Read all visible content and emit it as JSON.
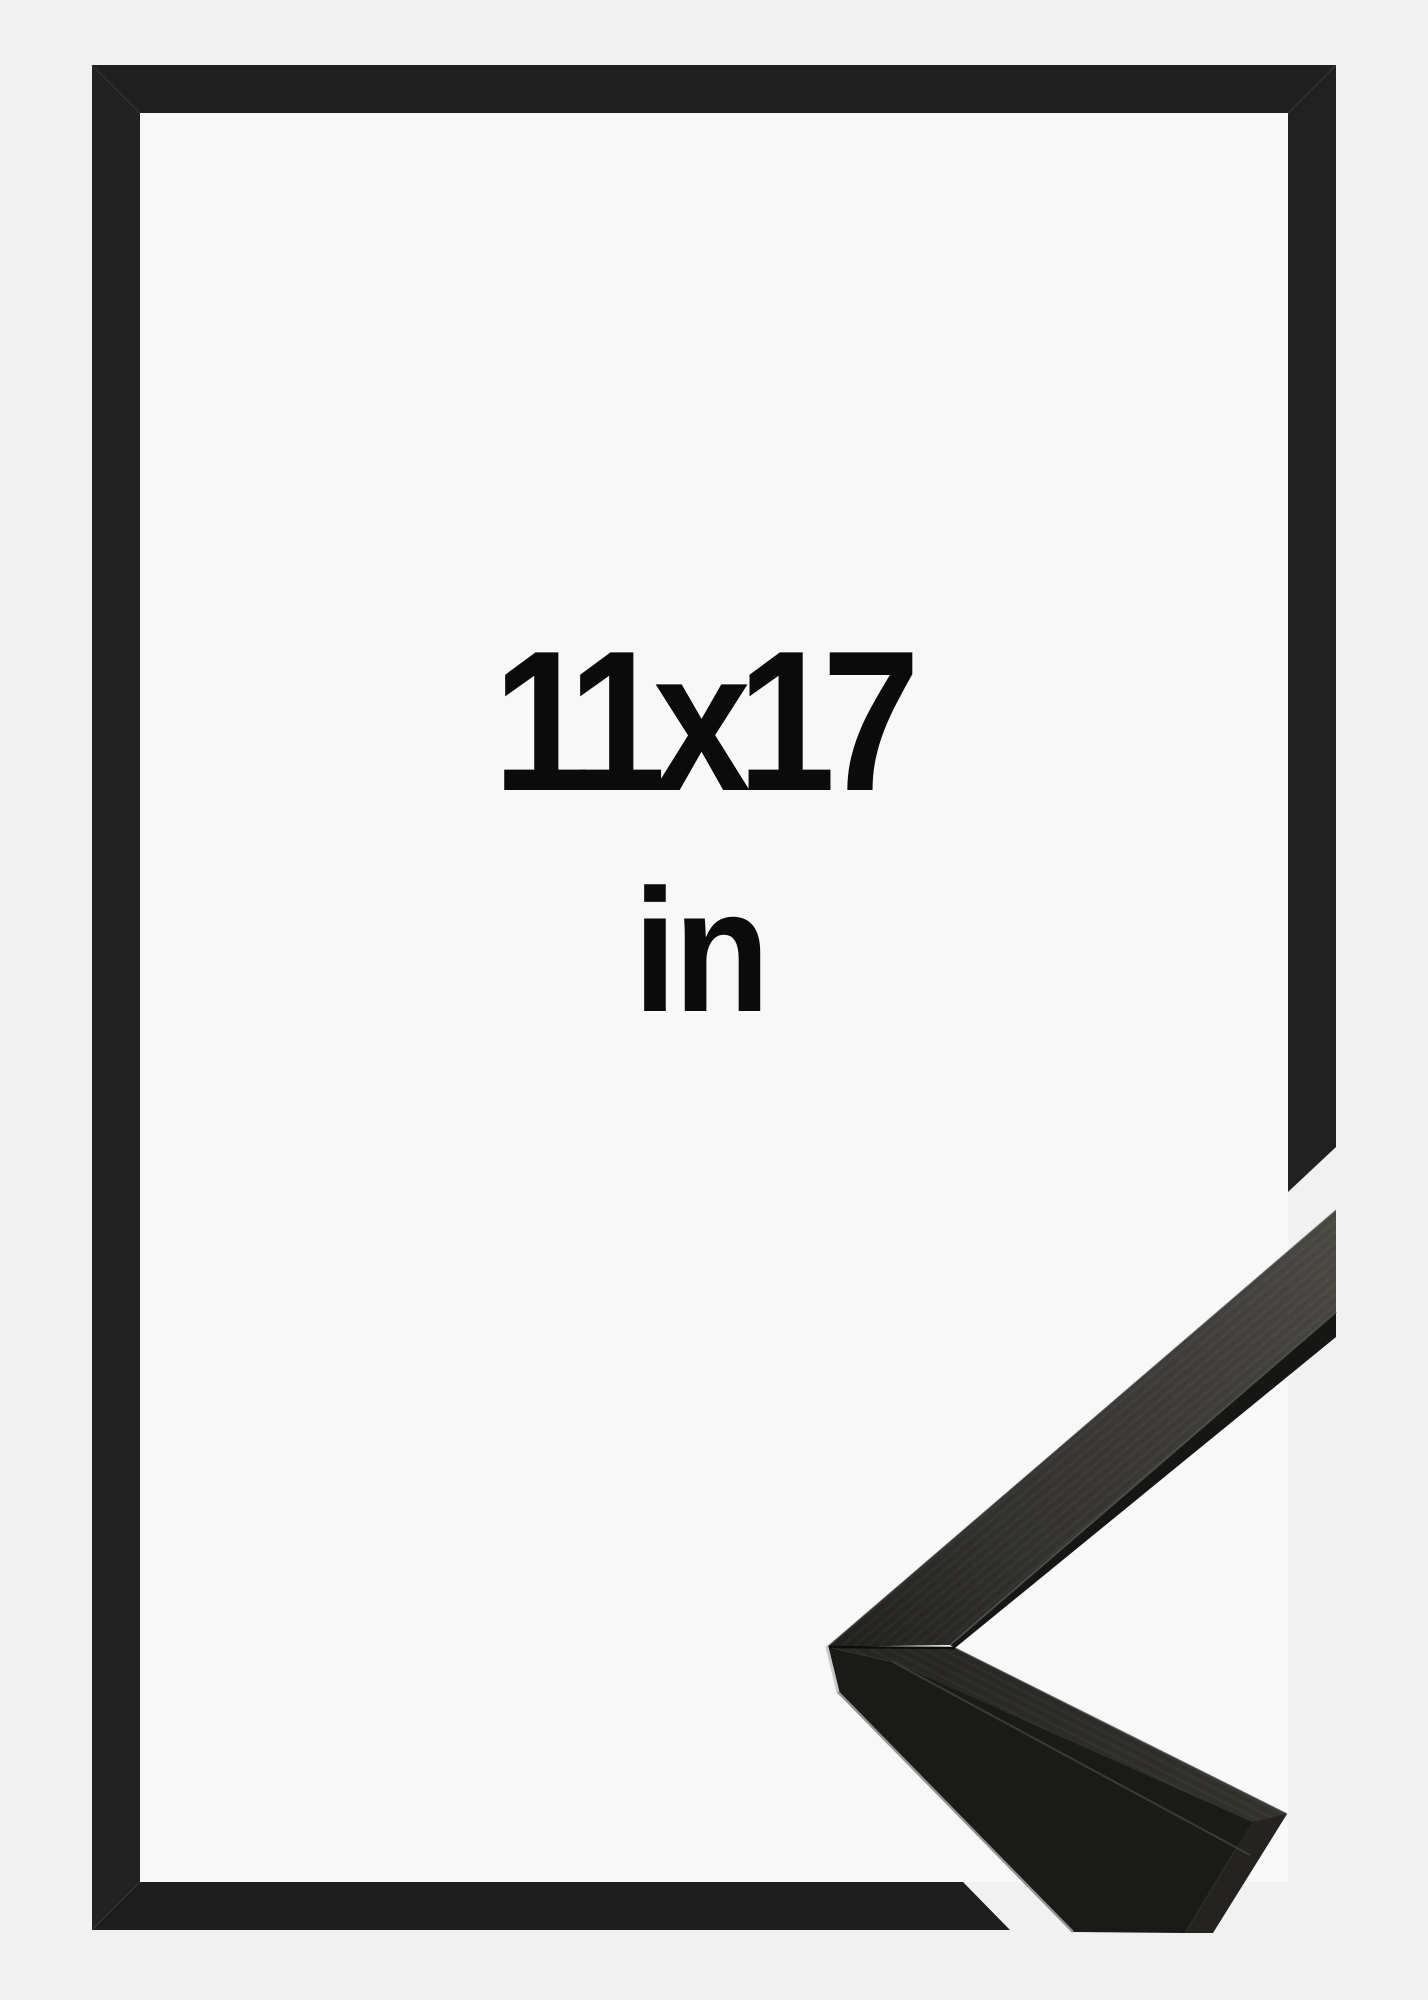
{
  "product": {
    "size_label": "11x17",
    "unit_label": "in",
    "description": "Black picture frame shown as flat outline with 3D corner profile sample"
  },
  "colors": {
    "background_outer": "#f1f1f2",
    "background_inner": "#f8f8f9",
    "frame_outline": "#212020",
    "sample_top_face_light": "#4b4a45",
    "sample_top_face_dark": "#23221f",
    "sample_side_face": "#1a1a19",
    "sample_highlight": "#c9c9c7",
    "text": "#0b0b0b"
  },
  "graphics": {
    "frame_outline_icon": "picture-frame-outline",
    "corner_sample_icon": "frame-corner-profile-sample"
  }
}
